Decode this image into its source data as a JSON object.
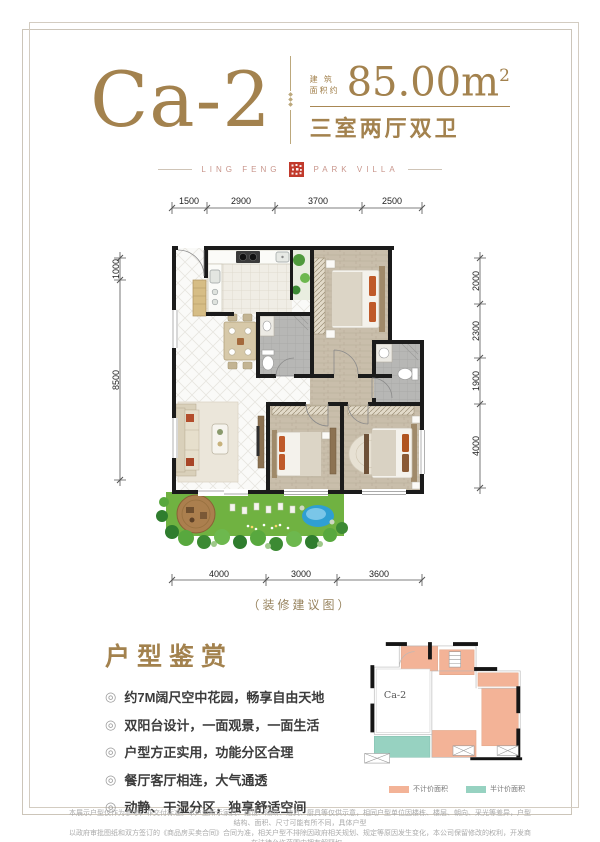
{
  "header": {
    "unit_code": "Ca-2",
    "area_label_top": "建 筑",
    "area_label_bottom": "面积约",
    "area_value": "85.00m",
    "area_exponent": "2",
    "layout_type": "三室两厅双卫",
    "divider_ornament": "◆\n◆\n◆"
  },
  "brand": {
    "left_text": "LING FENG",
    "right_text": "PARK VILLA"
  },
  "floorplan": {
    "caption": "（装修建议图）",
    "dims_top": [
      "1500",
      "2900",
      "3700",
      "2500"
    ],
    "dims_left": [
      "1000",
      "8500"
    ],
    "dims_right": [
      "2000",
      "2300",
      "1900",
      "4000"
    ],
    "dims_bottom": [
      "4000",
      "3000",
      "3600"
    ]
  },
  "features": {
    "title": "户型鉴赏",
    "bullet_glyph": "◎",
    "items": [
      "约7M阔尺空中花园，畅享自由天地",
      "双阳台设计，一面观景，一面生活",
      "户型方正实用，功能分区合理",
      "餐厅客厅相连，大气通透",
      "动静、干湿分区，独享舒适空间"
    ]
  },
  "mini_plan": {
    "label": "Ca-2",
    "legend": [
      {
        "color": "#f3b397",
        "label": "不计价面积"
      },
      {
        "color": "#97d2c1",
        "label": "半计价面积"
      }
    ]
  },
  "disclaimer": {
    "line1": "本展示户型仅作为参考，非交付标准。本户型所示家具、摆设、隔断、洁具、厨具等仅供示意，相同户型单位因楼栋、楼层、朝向、采光等差异，户型结构、面积、尺寸可能有所不同，具体户型",
    "line2": "以政府审批图纸和双方签订的《商品房买卖合同》合同为准，相关户型不排除因政府相关规划、规定等原因发生变化，本公司保留修改的权利，开发商在法律允许范围内拥有解释权。"
  },
  "colors": {
    "brand_gold": "#a3824e",
    "seal_red": "#c13a2c",
    "plan_salmon": "#f3b397",
    "plan_teal": "#97d2c1",
    "garden_green": "#70b241"
  }
}
